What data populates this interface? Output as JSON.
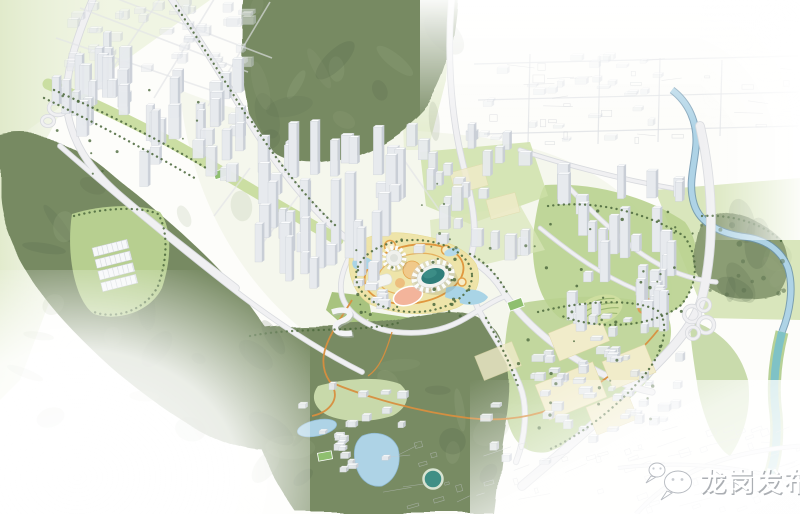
{
  "scene": {
    "kind": "aerial-masterplan-rendering",
    "description": "Bird's-eye urban design rendering: white 3D building massing along a valley corridor, dark forested hills, a central stadium and sports hub with yellow plazas, lakes, rivers, highways and parks; the edges of the plan fade out into a white line-drawing base map."
  },
  "watermark": {
    "icon": "chat-bubbles-icon",
    "text": "龙岗发布"
  },
  "colors": {
    "background": "#fdfdfa",
    "hill_dark": "#778a62",
    "hill_mid": "#889970",
    "park_green": "#b9d18f",
    "park_light": "#cfe0ad",
    "axis_green": "#c8dc9e",
    "water_blue": "#aed3e6",
    "river_teal": "#7fc2c6",
    "pond_teal": "#3f8f85",
    "plaza_yellow": "#eee3a6",
    "accent_orange": "#e0973f",
    "salmon": "#f3b49b",
    "stadium_teal": "#2f7e7a",
    "building_face": "#e7eaee",
    "building_side": "#c9ced6",
    "building_roof": "#fcfdfe",
    "road_casing": "#d8dade",
    "road_fill": "#f0f0f2",
    "tree_dot": "#4d6a3e",
    "sketch_line": "#c6c9cf",
    "watermark_text": "#ffffff",
    "watermark_shadow": "#8f949a"
  }
}
